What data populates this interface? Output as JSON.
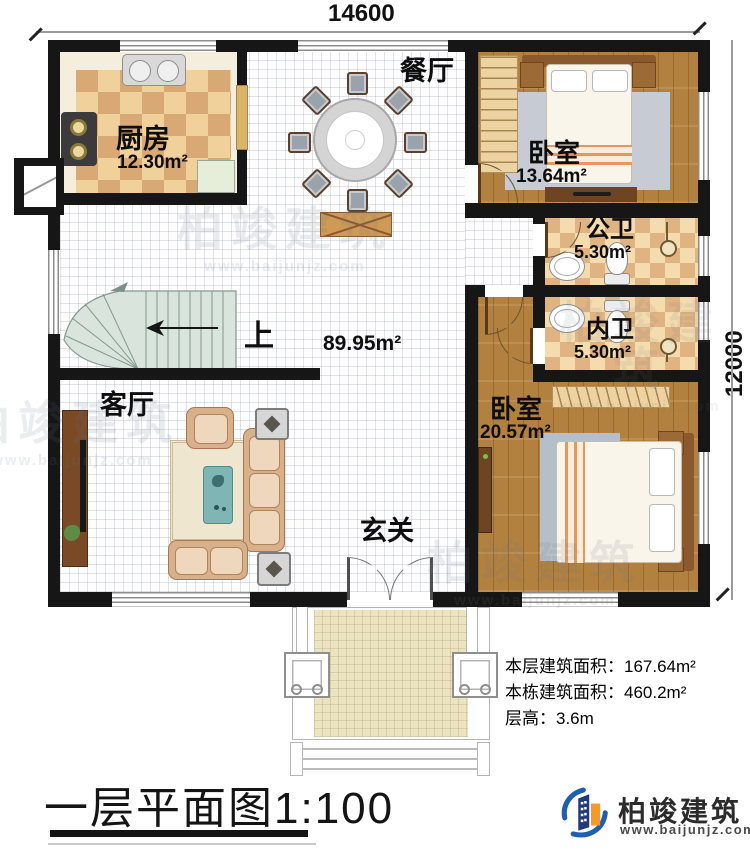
{
  "dimensions": {
    "top": "14600",
    "right": "12000"
  },
  "rooms": {
    "kitchen": {
      "name": "厨房",
      "area": "12.30m²"
    },
    "dining": {
      "name": "餐厅"
    },
    "bedroom_top": {
      "name": "卧室",
      "area": "13.64m²"
    },
    "bath_public": {
      "name": "公卫",
      "area": "5.30m²"
    },
    "bath_private": {
      "name": "内卫",
      "area": "5.30m²"
    },
    "bedroom_bottom": {
      "name": "卧室",
      "area": "20.57m²"
    },
    "living": {
      "name": "客厅"
    },
    "entry": {
      "name": "玄关"
    },
    "stairs": {
      "up": "上"
    },
    "open": {
      "area": "89.95m²"
    }
  },
  "info": {
    "floor_area_label": "本层建筑面积：",
    "floor_area_value": "167.64m²",
    "building_area_label": "本栋建筑面积：",
    "building_area_value": "460.2m²",
    "height_label": "层高：",
    "height_value": "3.6m"
  },
  "title": "一层平面图1:100",
  "brand": {
    "name": "柏竣建筑",
    "site": "www.baijunjz.com"
  },
  "watermark": {
    "name": "柏竣建筑",
    "site": "www.baijunjz.com"
  },
  "colors": {
    "wall": "#161616",
    "wood": "#b2813f",
    "checker_light": "#f0d09b",
    "checker_dark": "#d8a974",
    "brand_blue": "#1e5fb0",
    "brand_orange": "#f49a2d"
  }
}
